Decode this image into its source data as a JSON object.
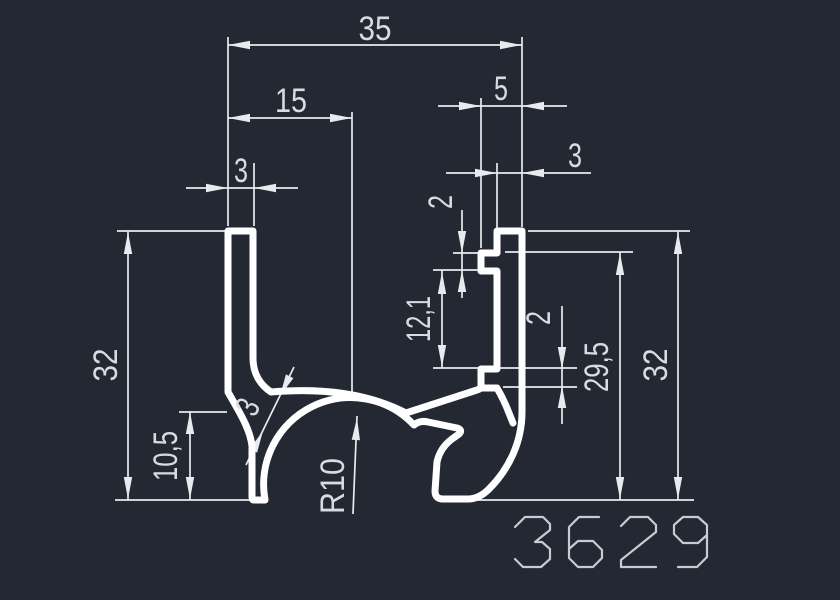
{
  "drawing": {
    "part_number": "3629",
    "colors": {
      "background": "#232832",
      "profile_outline": "#ffffff",
      "dimension_lines": "#e8eaee",
      "dimension_text": "#d9dcdf",
      "part_number_text": "#c7ccd2"
    },
    "dimensions": {
      "width_total": "35",
      "width_left_to_center": "15",
      "left_wall_thickness": "3",
      "right_top_width": "5",
      "right_wall_thickness": "3",
      "top_tab_height": "2",
      "tab_gap": "12,1",
      "bottom_tab_height": "2",
      "left_inner_height": "10,5",
      "left_height": "32",
      "right_inner_height": "29,5",
      "right_height": "32",
      "arch_radius": "R10",
      "web_thickness": "3"
    }
  }
}
